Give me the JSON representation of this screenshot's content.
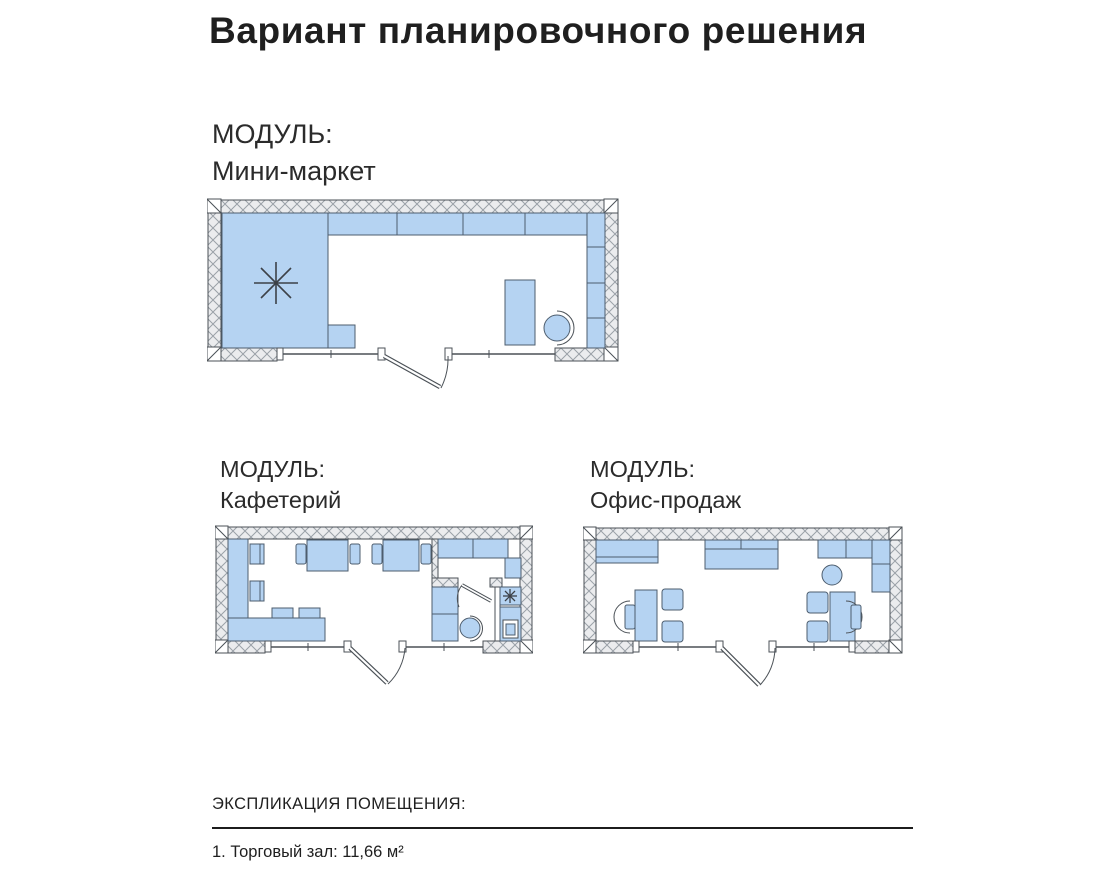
{
  "title": "Вариант планировочного решения",
  "modules": [
    {
      "label": "МОДУЛЬ:",
      "name": "Мини-маркет"
    },
    {
      "label": "МОДУЛЬ:",
      "name": "Кафетерий"
    },
    {
      "label": "МОДУЛЬ:",
      "name": "Офис-продаж"
    }
  ],
  "explication": {
    "heading": "ЭКСПЛИКАЦИЯ ПОМЕЩЕНИЯ:",
    "items": [
      "1. Торговый зал: 11,66 м²"
    ]
  },
  "icons": {
    "ceiling_light": "8-spoke asterisk light symbol",
    "door_swing": "quarter-circle door swing arc"
  },
  "colors": {
    "furniture-fill": "#b5d3f2",
    "furniture-stroke": "#4d5d6e",
    "wall-fill": "#ebecee",
    "wall-hatch": "#9aa1a8",
    "plan-line": "#4b5157",
    "rule-color": "#1c1c1c",
    "text-color": "#1f1f1f"
  }
}
